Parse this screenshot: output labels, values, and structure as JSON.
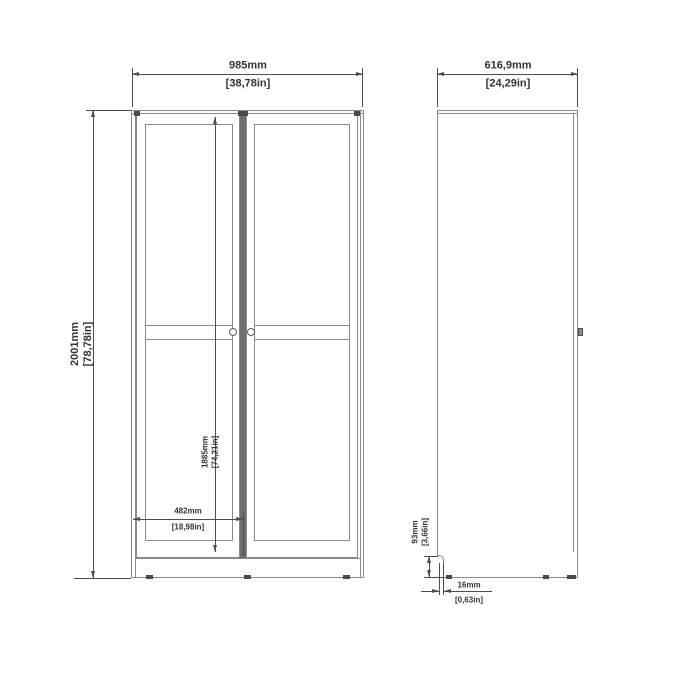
{
  "drawing": {
    "title": "wardrobe-dimension-drawing",
    "colors": {
      "background": "#ffffff",
      "outline": "#8a8a8a",
      "dimension": "#4d4d4d",
      "text": "#333333",
      "dark_marks": "#4a4a4a"
    },
    "front": {
      "width": {
        "mm": "985mm",
        "in": "[38,78in]"
      },
      "height": {
        "mm": "2001mm",
        "in": "[78,78in]"
      },
      "door_height": {
        "mm": "1885mm",
        "in": "[74,21in]"
      },
      "door_width": {
        "mm": "482mm",
        "in": "[18,98in]"
      }
    },
    "side": {
      "depth": {
        "mm": "616,9mm",
        "in": "[24,29in]"
      },
      "plinth_height": {
        "mm": "93mm",
        "in": "[3,66in]"
      },
      "panel_thickness": {
        "mm": "16mm",
        "in": "[0,63in]"
      }
    }
  }
}
